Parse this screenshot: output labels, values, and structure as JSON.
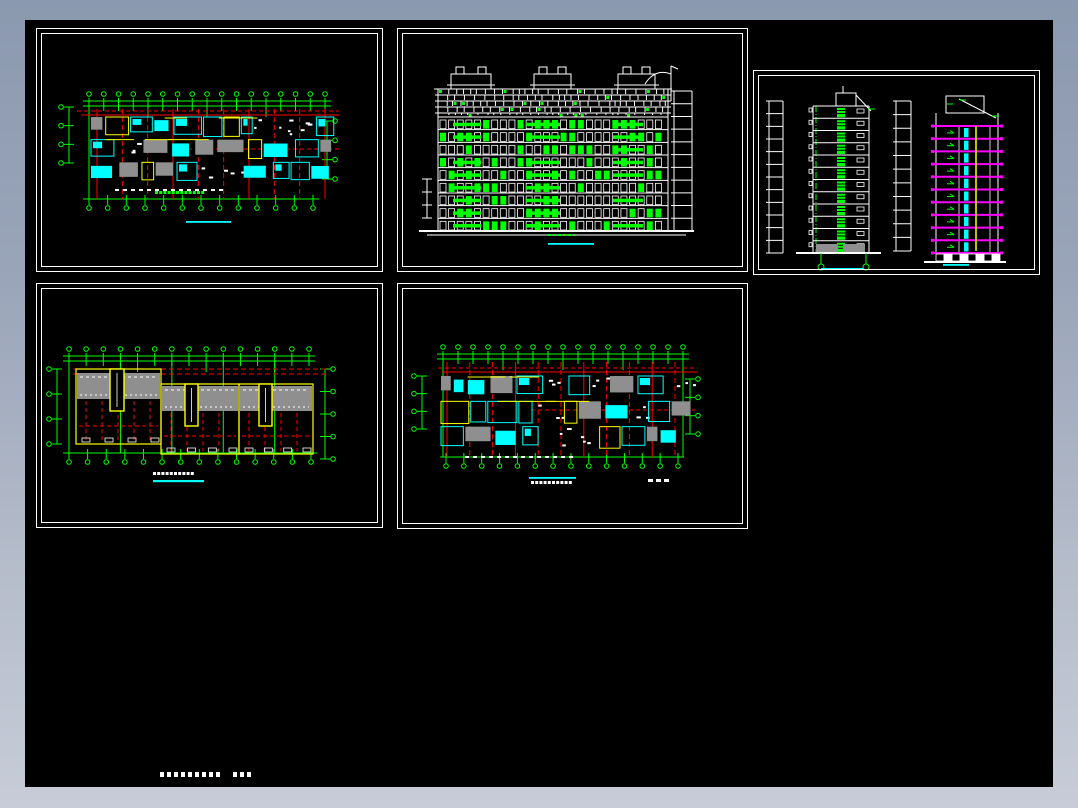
{
  "window": {
    "frame_gradient_top": "#8b99b0",
    "frame_gradient_bottom": "#c7ccd8",
    "canvas_background": "#000000",
    "border_left": 25,
    "border_top": 20,
    "border_right": 25,
    "border_bottom": 21
  },
  "palette": {
    "grid_green": "#00ff00",
    "axis_red": "#ff0000",
    "fixture_cyan": "#00ffff",
    "accent_yellow": "#ffff00",
    "slab_magenta": "#ff00ff",
    "hatch_gray": "#8f8f8f",
    "line_white": "#ffffff",
    "title_underline": "#00ffff"
  },
  "panels": [
    {
      "id": "p1",
      "name": "floor-plan-1",
      "type": "plan",
      "seed": 101,
      "box": {
        "x": 11,
        "y": 8,
        "w": 347,
        "h": 244
      },
      "spec": {
        "grid_top": {
          "x1": 52,
          "x2": 288,
          "y": 72,
          "n": 17
        },
        "grid_bottom": {
          "x1": 52,
          "x2": 276,
          "y": 170,
          "n": 13
        },
        "dim_left": {
          "x": 32,
          "y1": 78,
          "y2": 134,
          "n": 4,
          "side": "left"
        },
        "dim_right": {
          "x": 290,
          "y1": 92,
          "y2": 150,
          "n": 4,
          "side": "right"
        },
        "body": {
          "x": 54,
          "y": 88,
          "w": 240,
          "h": 68
        },
        "red": {
          "y_dash": 82,
          "y_solid": 86,
          "y_mid": 120,
          "x1": 40,
          "x2": 302,
          "verticals": 10
        },
        "title": {
          "x": 118,
          "y": 162,
          "n": 12,
          "color": "#00ff00"
        },
        "underline": {
          "x": 149,
          "y": 192,
          "w": 45
        }
      }
    },
    {
      "id": "p2",
      "name": "building-elevation",
      "type": "elevation",
      "seed": 202,
      "box": {
        "x": 372,
        "y": 8,
        "w": 351,
        "h": 244
      },
      "spec": {
        "facade": {
          "x": 40,
          "y": 60,
          "w": 230,
          "h": 142,
          "floors": 9,
          "lattice_h": 26
        },
        "ground": {
          "x1": 21,
          "x2": 296,
          "y": 202
        },
        "bulk": {
          "y": 45,
          "h": 15,
          "items": [
            {
              "x": 53,
              "w": 40
            },
            {
              "x": 136,
              "w": 37
            },
            {
              "x": 220,
              "w": 37
            }
          ]
        },
        "ladder": {
          "x1": 276,
          "x2": 294,
          "y1": 62,
          "y2": 202,
          "n": 11
        },
        "mast": {
          "x": 273,
          "y": 37
        },
        "underline": {
          "x": 150,
          "y": 214,
          "w": 46
        }
      }
    },
    {
      "id": "p3",
      "name": "building-sections",
      "type": "sections",
      "seed": 303,
      "box": {
        "x": 728,
        "y": 50,
        "w": 287,
        "h": 205
      },
      "spec": {
        "left": {
          "ladder_x": 15,
          "bx": 59,
          "bw": 56,
          "by": 35,
          "bh": 147,
          "floors": 12,
          "underline": {
            "x": 67,
            "y": 197,
            "w": 42
          }
        },
        "right": {
          "ladder_x": 142,
          "bx": 182,
          "bw": 62,
          "wall_top": 42,
          "slab_top": 55,
          "slab_bot": 182,
          "floors": 10,
          "underline": {
            "x": 189,
            "y": 193,
            "w": 26
          }
        }
      }
    },
    {
      "id": "p4",
      "name": "roof-plan",
      "type": "roof",
      "seed": 404,
      "box": {
        "x": 11,
        "y": 263,
        "w": 347,
        "h": 245
      },
      "spec": {
        "grid_top": {
          "x1": 32,
          "x2": 272,
          "y": 72,
          "n": 15
        },
        "grid_bottom": {
          "x1": 32,
          "x2": 274,
          "y": 169,
          "n": 14
        },
        "dim_left": {
          "x": 20,
          "y1": 85,
          "y2": 160,
          "n": 4,
          "side": "left"
        },
        "dim_right": {
          "x": 288,
          "y1": 85,
          "y2": 175,
          "n": 5,
          "side": "right"
        },
        "red_lines": [
          85,
          90
        ],
        "blocks": [
          {
            "x": 39,
            "y": 85,
            "w": 85,
            "h": 75,
            "gy": 89,
            "gh": 26
          },
          {
            "x": 124,
            "y": 100,
            "w": 78,
            "h": 70,
            "gy": 102,
            "gh": 25
          },
          {
            "x": 202,
            "y": 100,
            "w": 74,
            "h": 70,
            "gy": 102,
            "gh": 25
          }
        ],
        "chimneys": [
          {
            "x": 73,
            "y": 85,
            "w": 14,
            "h": 42
          },
          {
            "x": 148,
            "y": 100,
            "w": 13,
            "h": 42
          },
          {
            "x": 222,
            "y": 100,
            "w": 13,
            "h": 42
          }
        ],
        "title": {
          "x": 116,
          "y": 188,
          "n": 10,
          "color": "#ffffff"
        },
        "underline": {
          "x": 116,
          "y": 196,
          "w": 51
        }
      }
    },
    {
      "id": "p5",
      "name": "floor-plan-2",
      "type": "plan",
      "seed": 505,
      "box": {
        "x": 372,
        "y": 263,
        "w": 351,
        "h": 246
      },
      "spec": {
        "grid_top": {
          "x1": 45,
          "x2": 285,
          "y": 70,
          "n": 17
        },
        "grid_bottom": {
          "x1": 48,
          "x2": 280,
          "y": 173,
          "n": 14
        },
        "dim_left": {
          "x": 24,
          "y1": 92,
          "y2": 145,
          "n": 4,
          "side": "left"
        },
        "dim_right": {
          "x": 292,
          "y1": 95,
          "y2": 150,
          "n": 4,
          "side": "right"
        },
        "body": {
          "x": 43,
          "y": 92,
          "w": 240,
          "h": 76
        },
        "red": {
          "y_dash": 84,
          "y_solid": 88,
          "y_mid": 126,
          "x1": 40,
          "x2": 300,
          "verticals": 11
        },
        "title": {
          "x": 133,
          "y": 197,
          "n": 10,
          "color": "#ffffff"
        },
        "underline": {
          "x": 131,
          "y": 193,
          "w": 47
        },
        "jmark": {
          "x": 250,
          "y": 195
        }
      }
    }
  ],
  "footer": {
    "y": 752,
    "dash_groups": [
      {
        "x": 135,
        "n": 9
      },
      {
        "x": 208,
        "n": 3
      }
    ],
    "color": "#ffffff"
  }
}
